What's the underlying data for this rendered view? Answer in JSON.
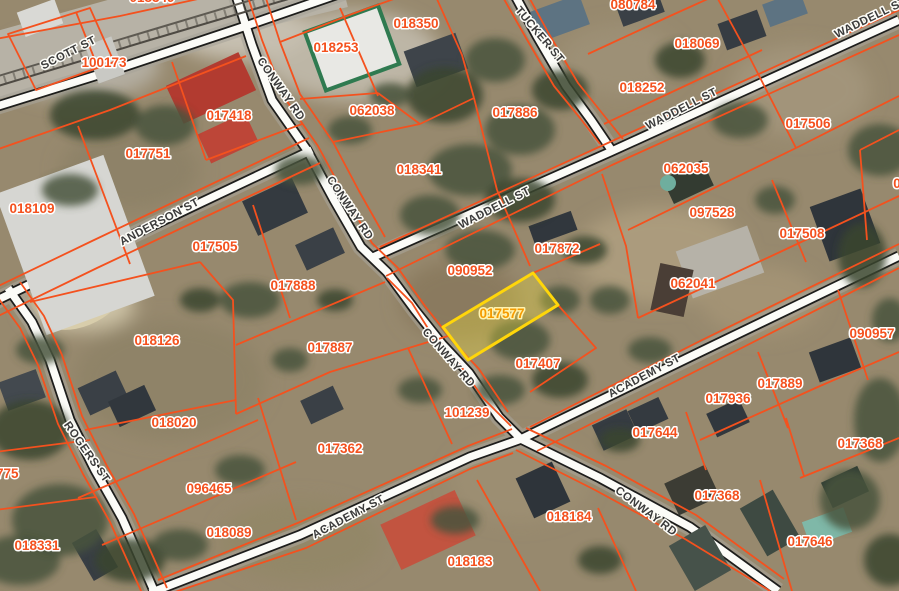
{
  "map": {
    "type_note": "GIS parcel viewer over aerial imagery",
    "colors": {
      "parcel_line": "#f4511e",
      "parcel_label": "#f4511e",
      "street_label": "#3b3b3b",
      "highlight_stroke": "#ffd60a",
      "highlight_fill": "rgba(238,220,60,0.35)",
      "highlight_label": "#f59b00"
    },
    "highlight_parcel": {
      "id": "017577",
      "x": 502,
      "y": 318,
      "rot": 0,
      "points": "443,327 533,273 558,305 468,360"
    },
    "parcel_labels": [
      {
        "id": "018349",
        "x": 152,
        "y": -3
      },
      {
        "id": "100173",
        "x": 104,
        "y": 62
      },
      {
        "id": "018253",
        "x": 336,
        "y": 47
      },
      {
        "id": "018350",
        "x": 416,
        "y": 23
      },
      {
        "id": "080784",
        "x": 633,
        "y": 4
      },
      {
        "id": "018069",
        "x": 697,
        "y": 43
      },
      {
        "id": "017418",
        "x": 229,
        "y": 115
      },
      {
        "id": "062038",
        "x": 372,
        "y": 110
      },
      {
        "id": "017886",
        "x": 515,
        "y": 112
      },
      {
        "id": "018252",
        "x": 642,
        "y": 87
      },
      {
        "id": "017506",
        "x": 808,
        "y": 123
      },
      {
        "id": "017751",
        "x": 148,
        "y": 153
      },
      {
        "id": "018341",
        "x": 419,
        "y": 169
      },
      {
        "id": "062035",
        "x": 686,
        "y": 168
      },
      {
        "id": "018109",
        "x": 32,
        "y": 208
      },
      {
        "id": "097528",
        "x": 712,
        "y": 212
      },
      {
        "id": "017505",
        "x": 215,
        "y": 246
      },
      {
        "id": "017872",
        "x": 557,
        "y": 248
      },
      {
        "id": "017508",
        "x": 802,
        "y": 233
      },
      {
        "id": "090952",
        "x": 470,
        "y": 270
      },
      {
        "id": "017888",
        "x": 293,
        "y": 285
      },
      {
        "id": "062041",
        "x": 693,
        "y": 283
      },
      {
        "id": "018126",
        "x": 157,
        "y": 340
      },
      {
        "id": "017887",
        "x": 330,
        "y": 347
      },
      {
        "id": "017407",
        "x": 538,
        "y": 363
      },
      {
        "id": "090957",
        "x": 872,
        "y": 333
      },
      {
        "id": "017889",
        "x": 780,
        "y": 383
      },
      {
        "id": "017936",
        "x": 728,
        "y": 398
      },
      {
        "id": "018020",
        "x": 174,
        "y": 422
      },
      {
        "id": "101239",
        "x": 467,
        "y": 412
      },
      {
        "id": "017644",
        "x": 655,
        "y": 432
      },
      {
        "id": "017362",
        "x": 340,
        "y": 448
      },
      {
        "id": "017368",
        "x": 860,
        "y": 443
      },
      {
        "id": "096465",
        "x": 209,
        "y": 488
      },
      {
        "id": "017368",
        "x": 717,
        "y": 495
      },
      {
        "id": "018089",
        "x": 229,
        "y": 532
      },
      {
        "id": "018184",
        "x": 569,
        "y": 516
      },
      {
        "id": "017646",
        "x": 810,
        "y": 541
      },
      {
        "id": "018331",
        "x": 37,
        "y": 545
      },
      {
        "id": "018183",
        "x": 470,
        "y": 561
      },
      {
        "id": "017775",
        "x": -4,
        "y": 473
      },
      {
        "id": "017910",
        "x": 645,
        "y": 597
      },
      {
        "id": "0",
        "x": 897,
        "y": 183
      }
    ],
    "street_labels": [
      {
        "name": "SCOTT ST",
        "x": 70,
        "y": 56,
        "rot": -27
      },
      {
        "name": "CONWAY RD",
        "x": 278,
        "y": 91,
        "rot": 55
      },
      {
        "name": "CONWAY RD",
        "x": 347,
        "y": 210,
        "rot": 56
      },
      {
        "name": "CONWAY RD",
        "x": 446,
        "y": 360,
        "rot": 49
      },
      {
        "name": "CONWAY RD",
        "x": 644,
        "y": 514,
        "rot": 37
      },
      {
        "name": "TUCKER ST",
        "x": 537,
        "y": 37,
        "rot": 50
      },
      {
        "name": "WADDELL ST",
        "x": 872,
        "y": 21,
        "rot": -26
      },
      {
        "name": "WADDELL ST",
        "x": 683,
        "y": 112,
        "rot": -27
      },
      {
        "name": "WADDELL ST",
        "x": 496,
        "y": 211,
        "rot": -27
      },
      {
        "name": "ANDERSON ST",
        "x": 161,
        "y": 225,
        "rot": -28
      },
      {
        "name": "ACADEMY ST",
        "x": 646,
        "y": 379,
        "rot": -28
      },
      {
        "name": "ACADEMY ST",
        "x": 350,
        "y": 520,
        "rot": -28
      },
      {
        "name": "ACADEMY ST",
        "x": 938,
        "y": 243,
        "rot": -28
      },
      {
        "name": "ROGERS ST",
        "x": 84,
        "y": 454,
        "rot": 55
      }
    ]
  }
}
